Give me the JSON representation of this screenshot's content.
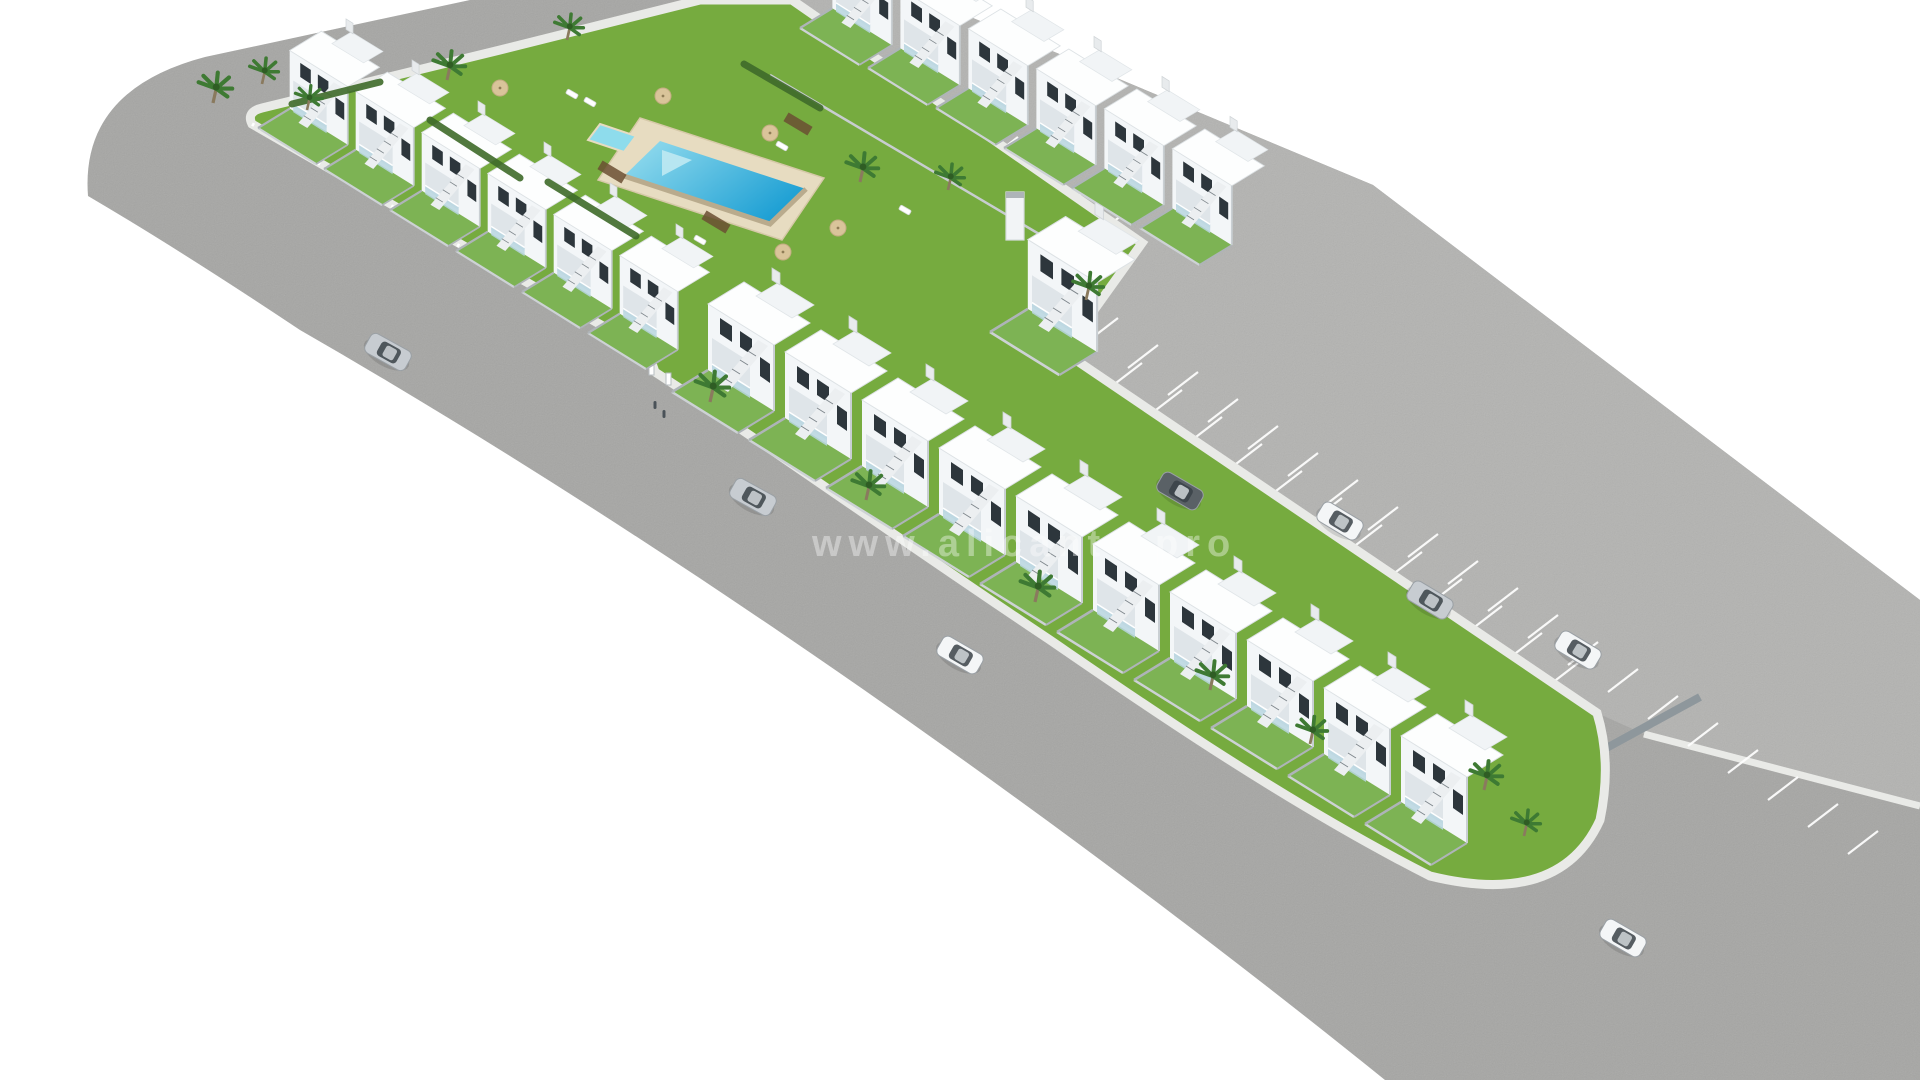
{
  "image": {
    "type": "3d-architectural-render",
    "subject": "Aerial 3D render of a residential development: white two-storey townhouses in an L-shape around a communal garden with swimming pool, ring road, striped parking bays and cars"
  },
  "watermark": {
    "text": "www.alicante-pro",
    "color": "#ffffff",
    "opacity": 0.38
  },
  "palette": {
    "background": "#ffffff",
    "road": "#a6a6a4",
    "parkingAsphalt": "#b3b3b1",
    "curb": "#e9eae7",
    "lawn": "#76ab3f",
    "gardenLawn": "#7db354",
    "hedge": "#3f6b2a",
    "palmGreen": "#3e7a33",
    "palmTrunk": "#8a7a5e",
    "deck": "#e7dcc1",
    "poolShallow": "#9adfef",
    "poolDeep": "#1ea0d4",
    "poolWall": "#b9ab8d",
    "facade": "#f3f6f8",
    "facadeShade": "#dfe5e9",
    "roofWhite": "#fdfefe",
    "wallGray": "#b5bbbf",
    "windowDark": "#2d363c",
    "glass": "#b9d6e0",
    "stripe": "#ffffff",
    "carSilver": "#c7ccd1",
    "carWhite": "#f4f6f7",
    "carDark": "#5a6166",
    "carGlass": "#3a4248",
    "decking": "#6b4f33",
    "figure": "#4a5258",
    "umbrella": "#d9c49a"
  },
  "complex": {
    "houseRows": [
      {
        "name": "front-row-upper",
        "start": [
          258,
          128
        ],
        "step": [
          66,
          41
        ],
        "count": 6,
        "scale": 0.88
      },
      {
        "name": "front-row-lower",
        "start": [
          672,
          392
        ],
        "step": [
          77,
          48
        ],
        "count": 10,
        "scale": 1.0
      },
      {
        "name": "back-row",
        "start": [
          800,
          28
        ],
        "step": [
          68,
          40
        ],
        "count": 6,
        "scale": 0.9
      },
      {
        "name": "connector-block",
        "start": [
          990,
          332
        ],
        "step": [
          0,
          0
        ],
        "count": 1,
        "scale": 1.05
      }
    ],
    "pool": {
      "deck": [
        [
          640,
          118
        ],
        [
          824,
          178
        ],
        [
          782,
          240
        ],
        [
          598,
          180
        ]
      ],
      "water": [
        [
          660,
          141
        ],
        [
          806,
          189
        ],
        [
          770,
          224
        ],
        [
          624,
          176
        ]
      ],
      "kids": [
        [
          600,
          124
        ],
        [
          636,
          136
        ],
        [
          624,
          152
        ],
        [
          588,
          140
        ]
      ],
      "steps": [
        [
          662,
          150
        ],
        [
          692,
          160
        ],
        [
          662,
          176
        ]
      ]
    }
  },
  "parking": {
    "upperStripes": {
      "start": [
        1118,
        318
      ],
      "step": [
        40,
        27
      ],
      "count": 20,
      "vec": [
        -30,
        23
      ]
    },
    "lowerStripes": {
      "start": [
        1112,
        386
      ],
      "step": [
        40,
        27
      ],
      "count": 12,
      "vec": [
        30,
        -23
      ]
    },
    "topStripes": {
      "start": [
        812,
        32
      ],
      "step": [
        36,
        25
      ],
      "count": 9,
      "vec": [
        26,
        -20
      ]
    }
  },
  "cars": [
    {
      "x": 388,
      "y": 352,
      "rot": 29,
      "color": "carSilver"
    },
    {
      "x": 753,
      "y": 497,
      "rot": 29,
      "color": "carSilver"
    },
    {
      "x": 960,
      "y": 655,
      "rot": 30,
      "color": "carWhite"
    },
    {
      "x": 1180,
      "y": 491,
      "rot": 30,
      "color": "carDark"
    },
    {
      "x": 1340,
      "y": 521,
      "rot": 31,
      "color": "carWhite"
    },
    {
      "x": 1430,
      "y": 600,
      "rot": 31,
      "color": "carSilver"
    },
    {
      "x": 1578,
      "y": 650,
      "rot": 31,
      "color": "carWhite"
    },
    {
      "x": 1623,
      "y": 938,
      "rot": 30,
      "color": "carWhite"
    }
  ],
  "palms": [
    [
      213,
      103,
      1.0
    ],
    [
      262,
      84,
      0.85
    ],
    [
      307,
      110,
      0.8
    ],
    [
      447,
      80,
      0.95
    ],
    [
      567,
      40,
      0.85
    ],
    [
      860,
      182,
      0.95
    ],
    [
      948,
      190,
      0.85
    ],
    [
      1086,
      300,
      0.9
    ],
    [
      710,
      402,
      1.0
    ],
    [
      866,
      500,
      0.95
    ],
    [
      1035,
      602,
      1.0
    ],
    [
      1210,
      690,
      0.95
    ],
    [
      1310,
      744,
      0.9
    ],
    [
      1484,
      790,
      0.95
    ],
    [
      1524,
      836,
      0.85
    ]
  ],
  "umbrellas": [
    [
      500,
      88
    ],
    [
      663,
      96
    ],
    [
      770,
      133
    ],
    [
      838,
      228
    ],
    [
      783,
      252
    ]
  ],
  "loungers": [
    [
      572,
      94
    ],
    [
      590,
      102
    ],
    [
      700,
      240
    ],
    [
      782,
      146
    ],
    [
      905,
      210
    ]
  ],
  "hedges": [
    [
      [
        292,
        104
      ],
      [
        380,
        82
      ]
    ],
    [
      [
        430,
        120
      ],
      [
        520,
        178
      ]
    ],
    [
      [
        548,
        182
      ],
      [
        636,
        236
      ]
    ],
    [
      [
        744,
        64
      ],
      [
        820,
        108
      ]
    ]
  ],
  "decking": [
    [
      612,
      172
    ],
    [
      716,
      222
    ],
    [
      798,
      124
    ]
  ],
  "figures": [
    [
      655,
      405
    ],
    [
      664,
      414
    ]
  ]
}
